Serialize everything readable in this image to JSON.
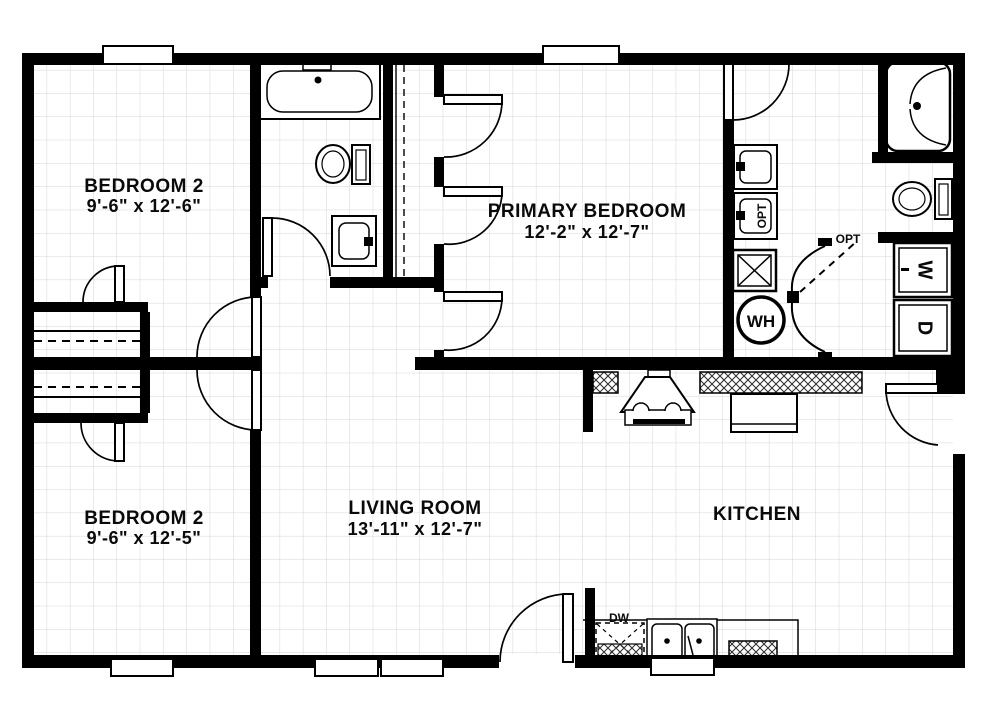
{
  "plan": {
    "background": "#ffffff",
    "wall_color": "#000000",
    "grid_color": "#d6d6d6",
    "rooms": [
      {
        "id": "bedroom-2-upper",
        "name": "BEDROOM 2",
        "dimensions": "9'-6\" x 12'-6\""
      },
      {
        "id": "primary-bedroom",
        "name": "PRIMARY BEDROOM",
        "dimensions": "12'-2\" x 12'-7\""
      },
      {
        "id": "bedroom-2-lower",
        "name": "BEDROOM 2",
        "dimensions": "9'-6\" x 12'-5\""
      },
      {
        "id": "living-room",
        "name": "LIVING ROOM",
        "dimensions": "13'-11\" x 12'-7\""
      },
      {
        "id": "kitchen",
        "name": "KITCHEN",
        "dimensions": ""
      }
    ],
    "labels": {
      "washer": "W",
      "dryer": "D",
      "water_heater": "WH",
      "dishwasher": "DW",
      "optional_door": "OPT",
      "optional_sink": "OPT"
    },
    "fixtures": [
      "bathtub",
      "toilet",
      "vanity-sink",
      "corner-shower",
      "double-vanity",
      "furnace",
      "water-heater",
      "washer",
      "dryer",
      "range-with-hood",
      "refrigerator",
      "double-basin-sink",
      "dishwasher",
      "closet-shelves"
    ]
  }
}
